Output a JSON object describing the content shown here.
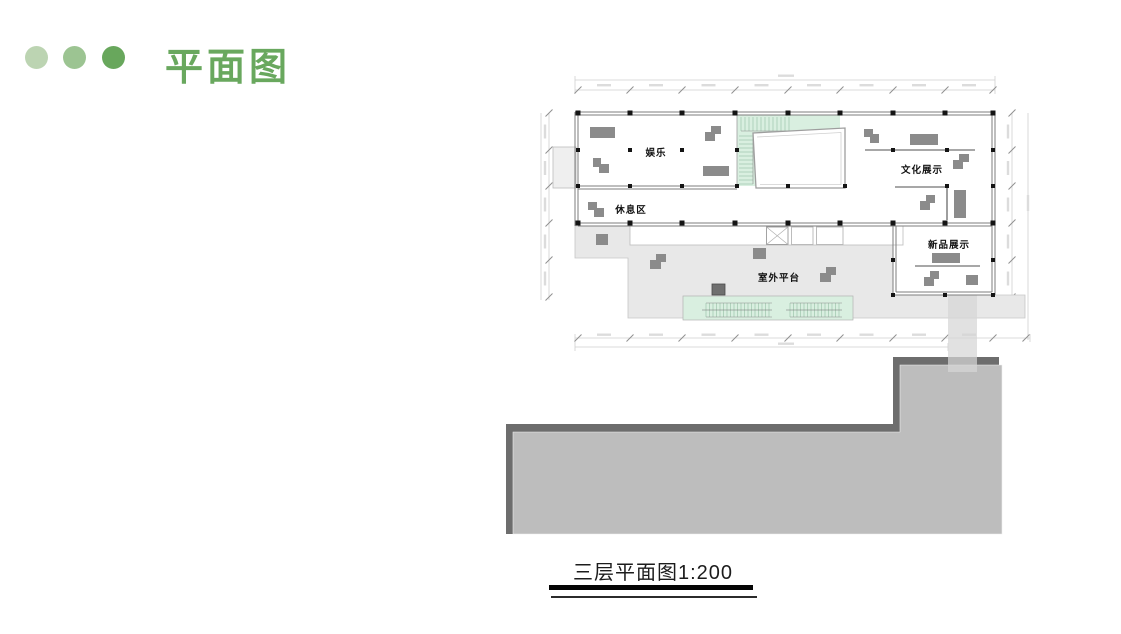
{
  "header": {
    "title": "平面图",
    "title_color": "#69a85e",
    "dots": [
      "#bcd4b2",
      "#9cc492",
      "#68a75c"
    ]
  },
  "plan": {
    "room_labels": {
      "entertainment": "娱乐",
      "rest_area": "休息区",
      "culture_display": "文化展示",
      "new_product_display": "新品展示",
      "outdoor_platform": "室外平台"
    },
    "colors": {
      "stair_green": "#d9efe0",
      "stair_tick": "#94bfa3",
      "platform_gray": "#e8e8e8",
      "roof_gray": "#bdbdbd",
      "roof_dark": "#6d6d6d",
      "wall": "#7e7e7e",
      "column": "#141414",
      "furniture": "#8b8b8b"
    }
  },
  "caption": {
    "text": "三层平面图1:200"
  }
}
